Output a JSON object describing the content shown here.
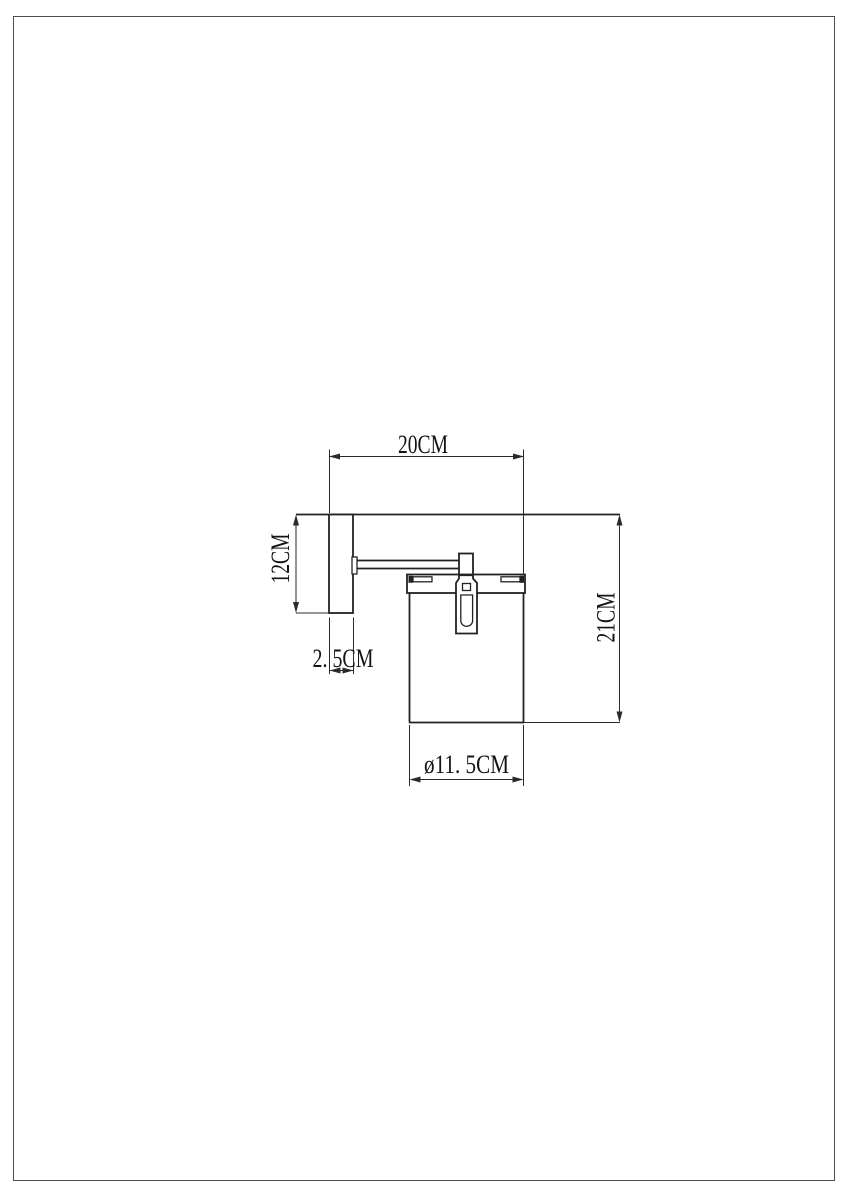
{
  "page": {
    "background": "#ffffff",
    "border_color": "#4d4d4d"
  },
  "drawing": {
    "kind": "wall-lamp-dimension-drawing",
    "line_color": "#222222",
    "dimensions": {
      "width_top": {
        "label": "20CM"
      },
      "plate_height": {
        "label": "12CM"
      },
      "plate_depth": {
        "label": "2. 5CM"
      },
      "total_height": {
        "label": "21CM"
      },
      "shade_diameter": {
        "label": "ø11. 5CM"
      }
    }
  }
}
